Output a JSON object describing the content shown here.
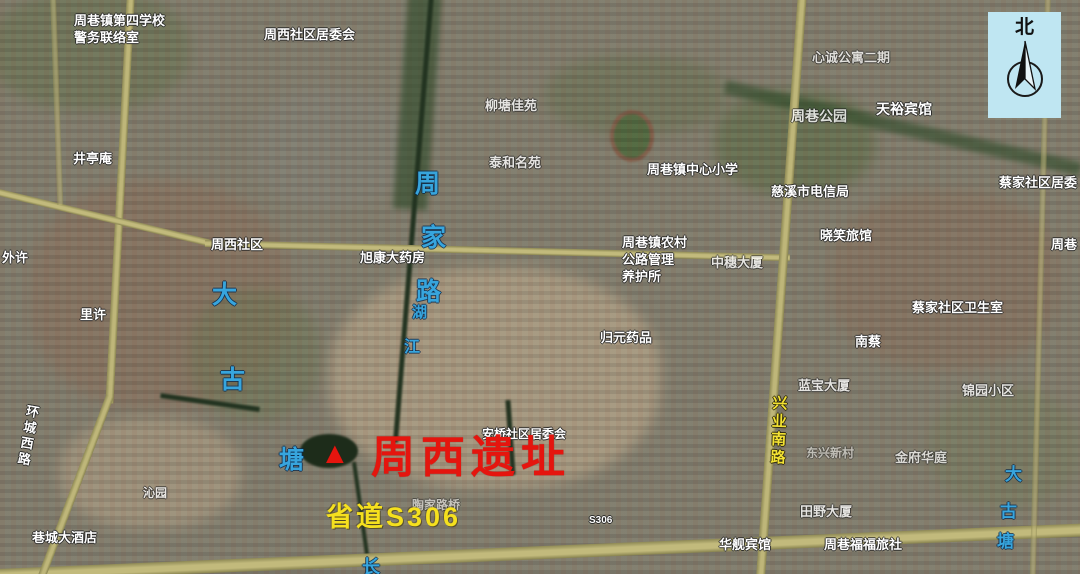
{
  "compass": {
    "north": "北"
  },
  "labels": [
    {
      "name": "label-school-police-office",
      "kind": "white",
      "x": 74,
      "y": 13,
      "fs": 13,
      "lines": [
        "周巷镇第四学校",
        "警务联络室"
      ]
    },
    {
      "name": "label-zhouxi-community-committee",
      "kind": "white",
      "x": 264,
      "y": 27,
      "fs": 13,
      "text": "周西社区居委会"
    },
    {
      "name": "label-jingting-temple",
      "kind": "white",
      "x": 73,
      "y": 151,
      "fs": 13,
      "text": "井亭庵"
    },
    {
      "name": "label-liutang-jiayuan",
      "kind": "white",
      "x": 485,
      "y": 98,
      "fs": 13,
      "op": 0.8,
      "text": "柳塘佳苑"
    },
    {
      "name": "label-taihe-mingyuan",
      "kind": "white",
      "x": 489,
      "y": 155,
      "fs": 13,
      "op": 0.8,
      "text": "泰和名苑"
    },
    {
      "name": "label-xincheng-apartment",
      "kind": "white",
      "x": 812,
      "y": 50,
      "fs": 13,
      "op": 0.75,
      "text": "心诚公寓二期"
    },
    {
      "name": "label-zhouxiang-park",
      "kind": "white",
      "x": 791,
      "y": 107,
      "fs": 14,
      "op": 0.8,
      "text": "周巷公园"
    },
    {
      "name": "label-tianyu-hotel",
      "kind": "white",
      "x": 876,
      "y": 100,
      "fs": 14,
      "text": "天裕宾馆"
    },
    {
      "name": "label-caijia-community-committee",
      "kind": "white",
      "x": 999,
      "y": 175,
      "fs": 13,
      "text": "蔡家社区居委"
    },
    {
      "name": "label-cixi-telecom-bureau",
      "kind": "white",
      "x": 771,
      "y": 184,
      "fs": 13,
      "text": "慈溪市电信局"
    },
    {
      "name": "label-zhouxiang-central-primary-school",
      "kind": "white",
      "x": 647,
      "y": 162,
      "fs": 13,
      "text": "周巷镇中心小学"
    },
    {
      "name": "label-xiaoxiao-inn",
      "kind": "white",
      "x": 820,
      "y": 228,
      "fs": 13,
      "text": "晓笑旅馆"
    },
    {
      "name": "label-zhouxi-community",
      "kind": "white",
      "x": 211,
      "y": 237,
      "fs": 13,
      "text": "周西社区"
    },
    {
      "name": "label-xukang-pharmacy",
      "kind": "white",
      "x": 360,
      "y": 250,
      "fs": 13,
      "text": "旭康大药房"
    },
    {
      "name": "label-road-maintenance-office",
      "kind": "white",
      "x": 622,
      "y": 235,
      "fs": 13,
      "lines": [
        "周巷镇农村",
        "公路管理",
        "养护所"
      ]
    },
    {
      "name": "label-zhongsui-building",
      "kind": "white",
      "x": 711,
      "y": 255,
      "fs": 13,
      "op": 0.8,
      "text": "中穗大厦"
    },
    {
      "name": "label-guiyuan-medicine",
      "kind": "white",
      "x": 600,
      "y": 330,
      "fs": 13,
      "text": "归元药品"
    },
    {
      "name": "label-caijia-community-clinic",
      "kind": "white",
      "x": 912,
      "y": 300,
      "fs": 13,
      "text": "蔡家社区卫生室"
    },
    {
      "name": "label-nancai",
      "kind": "white",
      "x": 855,
      "y": 334,
      "fs": 13,
      "text": "南蔡"
    },
    {
      "name": "label-waixu",
      "kind": "white",
      "x": 2,
      "y": 250,
      "fs": 13,
      "text": "外许"
    },
    {
      "name": "label-lixu",
      "kind": "white",
      "x": 80,
      "y": 307,
      "fs": 13,
      "text": "里许"
    },
    {
      "name": "label-lanbao-building",
      "kind": "white",
      "x": 798,
      "y": 378,
      "fs": 13,
      "op": 0.8,
      "text": "蓝宝大厦"
    },
    {
      "name": "label-jinyuan-residence",
      "kind": "white",
      "x": 962,
      "y": 383,
      "fs": 13,
      "op": 0.8,
      "text": "锦园小区"
    },
    {
      "name": "label-dongxing-village",
      "kind": "white",
      "x": 806,
      "y": 446,
      "fs": 12,
      "op": 0.5,
      "text": "东兴新村"
    },
    {
      "name": "label-jinfu-huating",
      "kind": "white",
      "x": 895,
      "y": 450,
      "fs": 13,
      "op": 0.72,
      "text": "金府华庭"
    },
    {
      "name": "label-tianye-building",
      "kind": "white",
      "x": 800,
      "y": 504,
      "fs": 13,
      "op": 0.8,
      "text": "田野大厦"
    },
    {
      "name": "label-huajian-hotel",
      "kind": "white",
      "x": 719,
      "y": 537,
      "fs": 13,
      "text": "华舰宾馆"
    },
    {
      "name": "label-zhouxiang-fufu-hostel",
      "kind": "white",
      "x": 824,
      "y": 537,
      "fs": 13,
      "text": "周巷福福旅社"
    },
    {
      "name": "label-xiangcheng-hotel",
      "kind": "white",
      "x": 32,
      "y": 530,
      "fs": 13,
      "text": "巷城大酒店"
    },
    {
      "name": "label-qinyuan",
      "kind": "white",
      "x": 143,
      "y": 486,
      "fs": 12,
      "op": 0.8,
      "text": "沁园"
    },
    {
      "name": "label-taojialu-bridge",
      "kind": "white",
      "x": 412,
      "y": 498,
      "fs": 12,
      "op": 0.55,
      "text": "陶家路桥"
    },
    {
      "name": "label-anqiao-community-committee",
      "kind": "white",
      "x": 482,
      "y": 427,
      "fs": 12,
      "text": "安桥社区居委会"
    },
    {
      "name": "label-clipped-right",
      "kind": "white",
      "x": 1051,
      "y": 237,
      "fs": 13,
      "text": "周巷"
    },
    {
      "name": "label-huancheng-west-road",
      "kind": "white",
      "vertical": true,
      "x": 18,
      "y": 404,
      "fs": 13,
      "rot": 10,
      "text": "环城西路"
    },
    {
      "name": "label-xingye-south-road",
      "kind": "yellow",
      "vertical": true,
      "x": 768,
      "y": 395,
      "fs": 15,
      "rot": 2,
      "text": "兴业南路"
    },
    {
      "name": "label-river-zhou",
      "kind": "blue",
      "x": 415,
      "y": 168,
      "fs": 25,
      "text": "周"
    },
    {
      "name": "label-river-jia",
      "kind": "blue",
      "x": 421,
      "y": 222,
      "fs": 25,
      "text": "家"
    },
    {
      "name": "label-river-lu",
      "kind": "blue",
      "x": 416,
      "y": 276,
      "fs": 25,
      "text": "路"
    },
    {
      "name": "label-river-hu",
      "kind": "blue",
      "x": 412,
      "y": 303,
      "fs": 15,
      "text": "湖"
    },
    {
      "name": "label-river-jiang",
      "kind": "blue",
      "x": 404,
      "y": 338,
      "fs": 16,
      "text": "江"
    },
    {
      "name": "label-dagutang-left-da",
      "kind": "blue",
      "x": 212,
      "y": 279,
      "fs": 25,
      "text": "大"
    },
    {
      "name": "label-dagutang-left-gu",
      "kind": "blue",
      "x": 220,
      "y": 364,
      "fs": 25,
      "text": "古"
    },
    {
      "name": "label-dagutang-left-tang",
      "kind": "blue",
      "x": 279,
      "y": 444,
      "fs": 25,
      "text": "塘"
    },
    {
      "name": "label-dagutang-right-da",
      "kind": "blue",
      "x": 1005,
      "y": 464,
      "fs": 17,
      "text": "大"
    },
    {
      "name": "label-dagutang-right-gu",
      "kind": "blue",
      "x": 1000,
      "y": 501,
      "fs": 17,
      "text": "古"
    },
    {
      "name": "label-dagutang-right-tang",
      "kind": "blue",
      "x": 997,
      "y": 531,
      "fs": 17,
      "text": "塘"
    },
    {
      "name": "label-blue-partial-bottom",
      "kind": "blue",
      "x": 362,
      "y": 556,
      "fs": 18,
      "text": "长"
    },
    {
      "name": "site-marker-triangle",
      "kind": "red",
      "x": 320,
      "y": 434,
      "fs": 30,
      "text": "▲"
    },
    {
      "name": "site-title-zhouxi-ruins",
      "kind": "red",
      "x": 371,
      "y": 429,
      "fs": 44,
      "ls": 6,
      "text": "周西遗址"
    },
    {
      "name": "label-provincial-road-s306",
      "kind": "yellow2",
      "x": 326,
      "y": 500,
      "fs": 27,
      "text": "省道S306"
    },
    {
      "name": "label-s306-shield",
      "kind": "white-small",
      "x": 589,
      "y": 514,
      "fs": 10,
      "text": "S306"
    }
  ]
}
